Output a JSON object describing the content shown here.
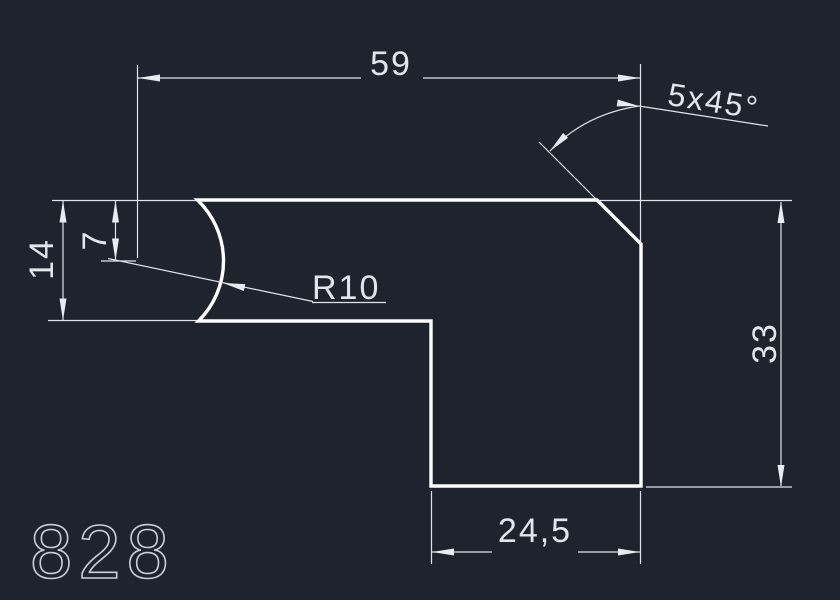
{
  "app": {
    "type": "cad-drawing-view",
    "background_color": "#1e232d"
  },
  "colors": {
    "part_outline": "#fdfdfe",
    "dimension_lines": "#dfe4ea",
    "dimension_text": "#e2e6ec",
    "part_number_text": "#c9cfd7"
  },
  "drawing": {
    "part_number": "828",
    "dimensions": {
      "top_width": "59",
      "chamfer_note": "5x45°",
      "center_offset": "7",
      "left_height": "14",
      "radius_note": "R10",
      "right_height": "33",
      "bottom_width": "24,5"
    }
  }
}
